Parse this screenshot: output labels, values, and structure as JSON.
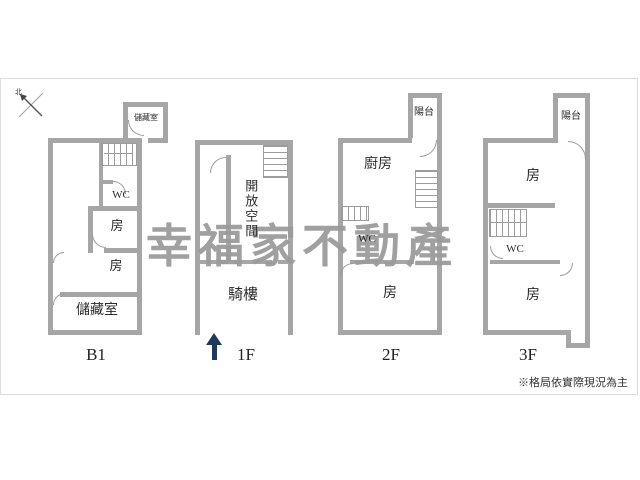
{
  "compass": {
    "label": "北"
  },
  "watermark": {
    "text": "幸福家不動產"
  },
  "note": {
    "text": "※格局依實際現況為主"
  },
  "colors": {
    "wall": "#a6a6a6",
    "line": "#9c9c9c",
    "watermark": "#9b9b9b",
    "arrow": "#1e3a5f"
  },
  "plans": {
    "b1": {
      "label": "B1",
      "storage_top": "儲藏室",
      "wc": "WC",
      "room_1": "房",
      "room_2": "房",
      "storage_bottom": "儲藏室"
    },
    "f1": {
      "label": "1F",
      "open_space": "開放空間",
      "arcade": "騎樓"
    },
    "f2": {
      "label": "2F",
      "balcony": "陽台",
      "kitchen": "廚房",
      "wc": "WC",
      "room": "房"
    },
    "f3": {
      "label": "3F",
      "balcony": "陽台",
      "room_top": "房",
      "wc": "WC",
      "room_bottom": "房"
    }
  }
}
